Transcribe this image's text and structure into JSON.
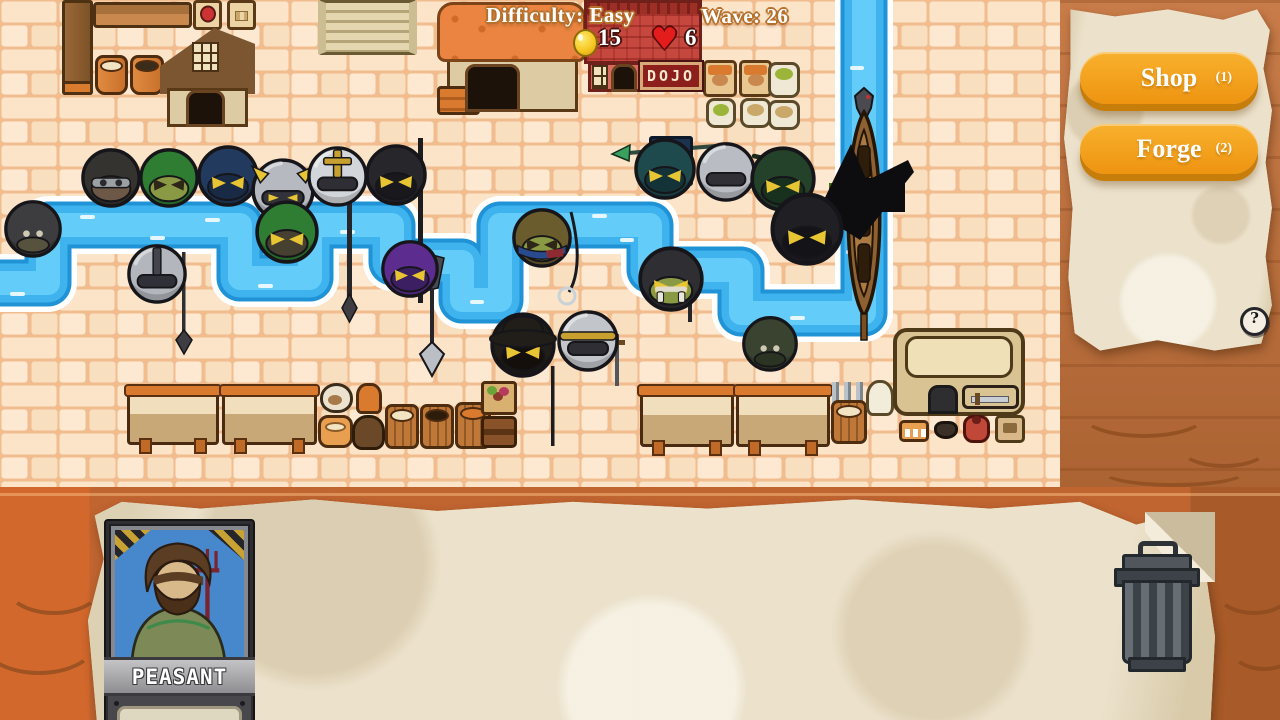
{
  "hud": {
    "difficulty_label": "Difficulty: Easy",
    "wave_label": "Wave: 26",
    "gold": "15",
    "lives": "6",
    "heart_glyph": "♥"
  },
  "buildings": {
    "dojo_sign": "DOJO"
  },
  "flag": {
    "number": "8"
  },
  "side_panel": {
    "shop_label": "Shop",
    "shop_hotkey": "(1)",
    "forge_label": "Forge",
    "forge_hotkey": "(2)",
    "help_label": "?"
  },
  "selected_card": {
    "name": "PEASANT",
    "description_line1": "A humble potato",
    "description_line2": "farmer. It's not much,"
  },
  "colors": {
    "accent_orange": "#f2991c",
    "river_blue": "#2ba3e2",
    "brick_light": "#fbe4c8",
    "parchment": "#e9dfc9",
    "wood": "#c4713a",
    "health_green": "#79b822",
    "hud_text": "#ffffff"
  },
  "units": [
    {
      "name": "rogue",
      "x": 80,
      "y": 146,
      "s": 62,
      "style": "hood",
      "body": "#35332f",
      "face": "#6d5848",
      "eyes": "",
      "trim": "goggles"
    },
    {
      "name": "green-archer",
      "x": 138,
      "y": 146,
      "s": 62,
      "style": "hood",
      "body": "#2e7d32",
      "face": "#8a9a44",
      "eyes": "#2e2618",
      "trim": ""
    },
    {
      "name": "navy-ninja",
      "x": 196,
      "y": 143,
      "s": 64,
      "style": "hood",
      "body": "#223a5e",
      "face": "#182a44",
      "eyes": "#e8c533",
      "trim": ""
    },
    {
      "name": "horned-knight",
      "x": 250,
      "y": 156,
      "s": 66,
      "style": "helm",
      "body": "#b6bac0",
      "face": "#32323a",
      "eyes": "#e8c533",
      "trim": "horns"
    },
    {
      "name": "green-knight",
      "x": 254,
      "y": 198,
      "s": 66,
      "style": "hood",
      "body": "#2e7d32",
      "face": "#45402f",
      "eyes": "#e8c533",
      "trim": ""
    },
    {
      "name": "cross-knight",
      "x": 306,
      "y": 144,
      "s": 63,
      "style": "helm",
      "body": "#d2d5d9",
      "face": "#2e2e34",
      "eyes": "",
      "trim": "cross"
    },
    {
      "name": "black-knight",
      "x": 364,
      "y": 142,
      "s": 64,
      "style": "hood",
      "body": "#26262b",
      "face": "#18181d",
      "eyes": "#e8c533",
      "trim": ""
    },
    {
      "name": "bomb-walker",
      "x": 3,
      "y": 198,
      "s": 60,
      "style": "orb",
      "body": "#3d3d3f",
      "face": "#56523e",
      "eyes": "#cfc9b4",
      "trim": ""
    },
    {
      "name": "sword-helm-knight",
      "x": 126,
      "y": 242,
      "s": 62,
      "style": "helm",
      "body": "#b3b7bd",
      "face": "#303038",
      "eyes": "",
      "trim": "sword"
    },
    {
      "name": "purple-assassin",
      "x": 380,
      "y": 238,
      "s": 60,
      "style": "hood",
      "body": "#5c2c8e",
      "face": "#3c1f62",
      "eyes": "#e8c533",
      "trim": ""
    },
    {
      "name": "fisherman",
      "x": 511,
      "y": 206,
      "s": 62,
      "style": "hood",
      "body": "#6b5c2e",
      "face": "#8a9a44",
      "eyes": "#2e2618",
      "trim": "scarf"
    },
    {
      "name": "flag-bearer",
      "x": 633,
      "y": 136,
      "s": 64,
      "style": "hood",
      "body": "#1e4a4d",
      "face": "#143338",
      "eyes": "#e8c533",
      "trim": ""
    },
    {
      "name": "gray-knight",
      "x": 695,
      "y": 140,
      "s": 62,
      "style": "helm",
      "body": "#b9bdc3",
      "face": "#303036",
      "eyes": "",
      "trim": ""
    },
    {
      "name": "forest-archer",
      "x": 749,
      "y": 144,
      "s": 68,
      "style": "hood",
      "body": "#24422a",
      "face": "#18301e",
      "eyes": "#e8c533",
      "trim": ""
    },
    {
      "name": "black-samurai",
      "x": 769,
      "y": 190,
      "s": 76,
      "style": "hood",
      "body": "#1f1f24",
      "face": "#131318",
      "eyes": "#e8c533",
      "trim": ""
    },
    {
      "name": "orc-samurai",
      "x": 637,
      "y": 244,
      "s": 68,
      "style": "hood",
      "body": "#2e2e33",
      "face": "#8a9a44",
      "eyes": "#e8c533",
      "trim": "tusks"
    },
    {
      "name": "pot-knight",
      "x": 556,
      "y": 308,
      "s": 64,
      "style": "helm",
      "body": "#c2c6cb",
      "face": "#2e2e34",
      "eyes": "",
      "trim": "band"
    },
    {
      "name": "hat-rogue",
      "x": 489,
      "y": 310,
      "s": 68,
      "style": "hood",
      "body": "#211d18",
      "face": "#140f0b",
      "eyes": "#e8c533",
      "trim": "hat"
    },
    {
      "name": "green-bomber",
      "x": 741,
      "y": 314,
      "s": 58,
      "style": "orb",
      "body": "#3a4230",
      "face": "#2b3322",
      "eyes": "#cfc9b4",
      "trim": ""
    }
  ]
}
